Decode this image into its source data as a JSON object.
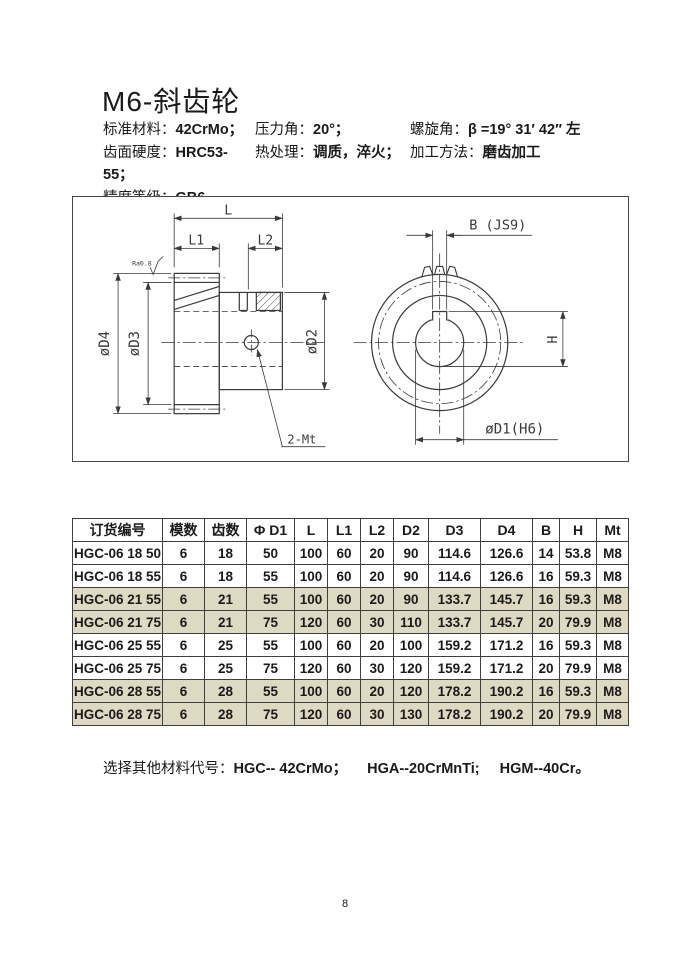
{
  "title": "M6-斜齿轮",
  "specs": {
    "rows": [
      {
        "c1l": "标准材料：",
        "c1v": "42CrMo；",
        "c2l": "压力角：",
        "c2v": "20°；",
        "c3l": "螺旋角：",
        "c3v": "β =19° 31′ 42″ 左"
      },
      {
        "c1l": "齿面硬度：",
        "c1v": "HRC53-55；",
        "c2l": "热处理：",
        "c2v": "调质，淬火；",
        "c3l": "加工方法：",
        "c3v": "磨齿加工"
      },
      {
        "c1l": "精度等级：",
        "c1v": "GB6",
        "c2l": "",
        "c2v": "",
        "c3l": "",
        "c3v": ""
      }
    ]
  },
  "drawing": {
    "labels": {
      "l": "L",
      "l1": "L1",
      "l2": "L2",
      "d4": "øD4",
      "d3": "øD3",
      "d2": "øD2",
      "mt": "2-Mt",
      "ra": "Ra0.8",
      "b": "B (JS9)",
      "h": "H",
      "d1": "øD1(H6)"
    }
  },
  "table": {
    "columns": [
      "订货编号",
      "模数",
      "齿数",
      "Φ D1",
      "L",
      "L1",
      "L2",
      "D2",
      "D3",
      "D4",
      "B",
      "H",
      "Mt"
    ],
    "rows": [
      {
        "shaded": false,
        "cells": [
          "HGC-06 18 50",
          "6",
          "18",
          "50",
          "100",
          "60",
          "20",
          "90",
          "114.6",
          "126.6",
          "14",
          "53.8",
          "M8"
        ]
      },
      {
        "shaded": false,
        "cells": [
          "HGC-06 18 55",
          "6",
          "18",
          "55",
          "100",
          "60",
          "20",
          "90",
          "114.6",
          "126.6",
          "16",
          "59.3",
          "M8"
        ]
      },
      {
        "shaded": true,
        "cells": [
          "HGC-06 21 55",
          "6",
          "21",
          "55",
          "100",
          "60",
          "20",
          "90",
          "133.7",
          "145.7",
          "16",
          "59.3",
          "M8"
        ]
      },
      {
        "shaded": true,
        "cells": [
          "HGC-06 21 75",
          "6",
          "21",
          "75",
          "120",
          "60",
          "30",
          "110",
          "133.7",
          "145.7",
          "20",
          "79.9",
          "M8"
        ]
      },
      {
        "shaded": false,
        "cells": [
          "HGC-06 25 55",
          "6",
          "25",
          "55",
          "100",
          "60",
          "20",
          "100",
          "159.2",
          "171.2",
          "16",
          "59.3",
          "M8"
        ]
      },
      {
        "shaded": false,
        "cells": [
          "HGC-06 25 75",
          "6",
          "25",
          "75",
          "120",
          "60",
          "30",
          "120",
          "159.2",
          "171.2",
          "20",
          "79.9",
          "M8"
        ]
      },
      {
        "shaded": true,
        "cells": [
          "HGC-06 28 55",
          "6",
          "28",
          "55",
          "100",
          "60",
          "20",
          "120",
          "178.2",
          "190.2",
          "16",
          "59.3",
          "M8"
        ]
      },
      {
        "shaded": true,
        "cells": [
          "HGC-06 28 75",
          "6",
          "28",
          "75",
          "120",
          "60",
          "30",
          "130",
          "178.2",
          "190.2",
          "20",
          "79.9",
          "M8"
        ]
      }
    ]
  },
  "note": {
    "label": "选择其他材料代号：",
    "items": [
      "HGC-- 42CrMo；",
      "HGA--20CrMnTi;",
      "HGM--40Cr。"
    ]
  },
  "page_number": "8",
  "colors": {
    "row_shade": "#ded9c3",
    "table_border": "#3f3f3f",
    "line": "#3a3a3a",
    "text": "#1a1a1a"
  }
}
